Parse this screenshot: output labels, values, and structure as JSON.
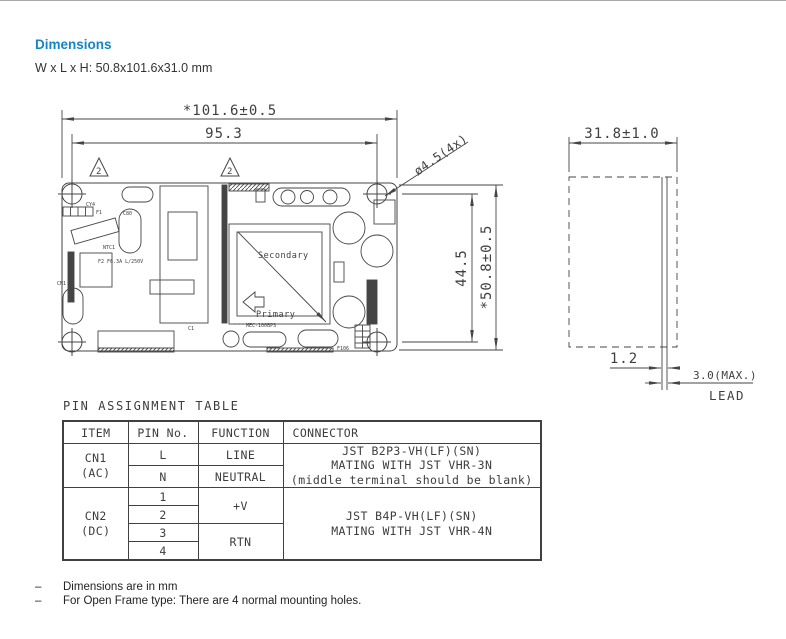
{
  "header": {
    "title": "Dimensions",
    "title_color": "#1485c6",
    "subtitle": "W x L x H: 50.8x101.6x31.0 mm"
  },
  "drawing": {
    "line_color": "#454545",
    "top_view": {
      "dim_overall_width": "*101.6±0.5",
      "dim_hole_pitch_width": "95.3",
      "dim_hole_pitch_height": "44.5",
      "dim_overall_height": "*50.8±0.5",
      "hole_callout": "ø4.5(4x)",
      "note_marker": "2",
      "labels": {
        "secondary": "Secondary",
        "primary": "Primary",
        "cn1": "CN1",
        "cy4": "CY4",
        "c80": "C80",
        "ntc1": "NTC1",
        "f1": "F1",
        "fuse2": "F2 F6.3A L/250V",
        "c1": "C1",
        "f106": "F106",
        "pcb_code": "MEC-100BPS"
      }
    },
    "side_view": {
      "dim_depth": "31.8±1.0",
      "dim_pcb_thickness": "1.2",
      "dim_lead_max": "3.0(MAX.)",
      "lead_label": "LEAD"
    }
  },
  "pin_table": {
    "title": "PIN ASSIGNMENT TABLE",
    "columns": {
      "item": "ITEM",
      "pin": "PIN No.",
      "function": "FUNCTION",
      "connector": "CONNECTOR"
    },
    "cn1": {
      "item": "CN1\n(AC)",
      "pin_l": "L",
      "function_l": "LINE",
      "pin_n": "N",
      "function_n": "NEUTRAL",
      "connector": "JST B2P3-VH(LF)(SN)\nMATING WITH JST VHR-3N\n(middle terminal should be blank)"
    },
    "cn2": {
      "item": "CN2\n(DC)",
      "pin_1": "1",
      "pin_2": "2",
      "pin_3": "3",
      "pin_4": "4",
      "function_12": "+V",
      "function_34": "RTN",
      "connector": "JST B4P-VH(LF)(SN)\nMATING WITH JST VHR-4N"
    }
  },
  "notes": {
    "bullet": "–",
    "items": [
      "Dimensions are in mm",
      "For Open Frame type: There are 4 normal mounting holes."
    ]
  }
}
